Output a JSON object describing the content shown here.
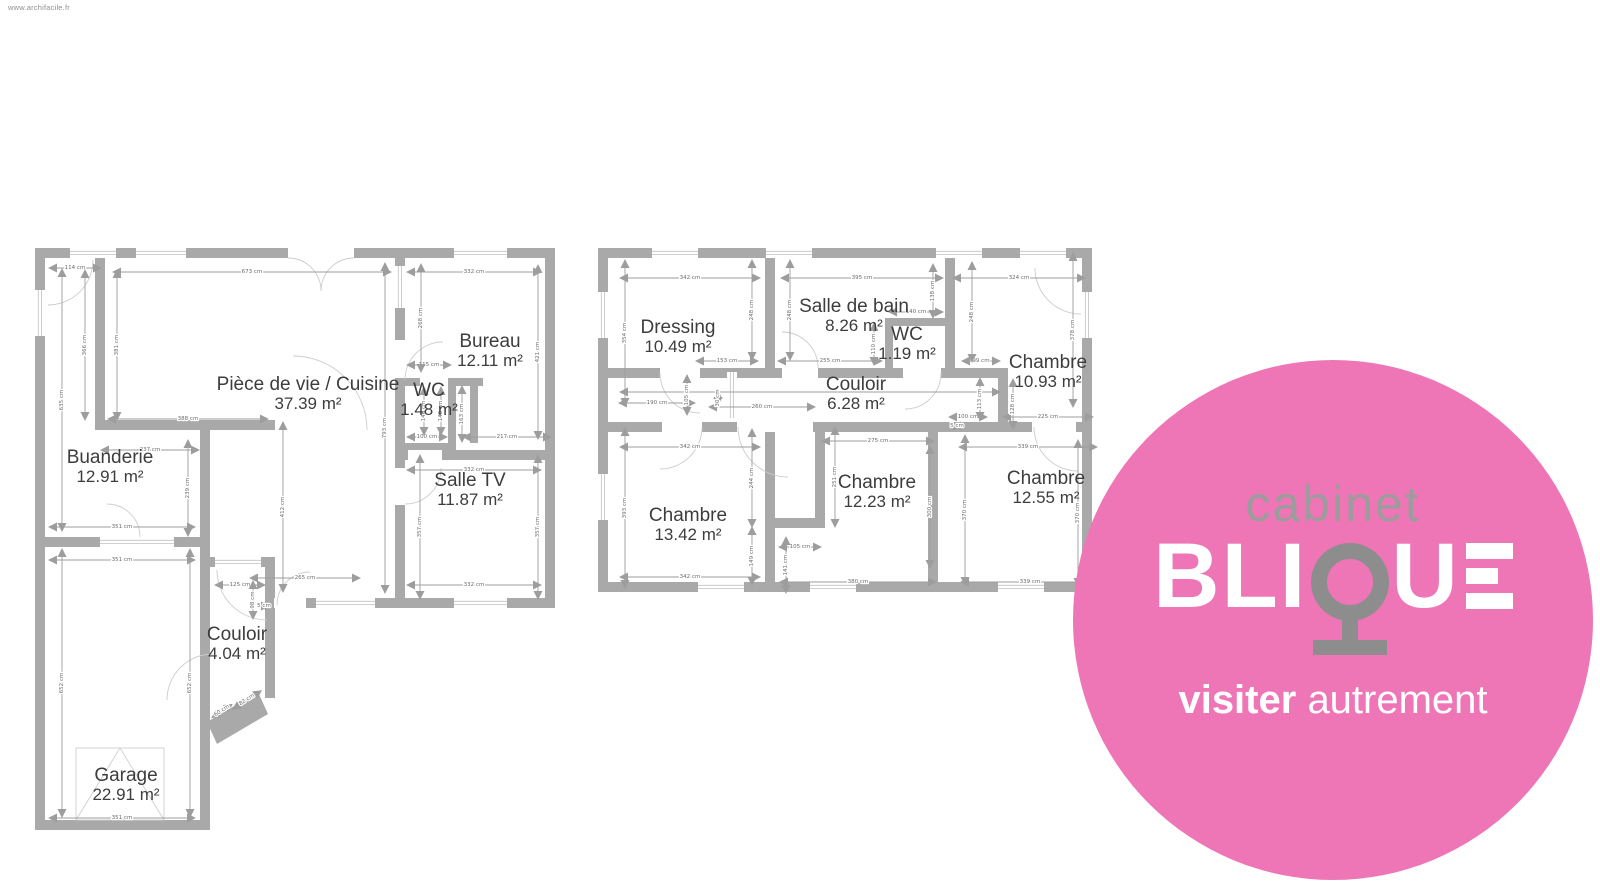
{
  "watermark": "www.archifacile.fr",
  "colors": {
    "wall": "#a9a9a9",
    "dim_line": "#9d9d9d",
    "window_line": "#c0c0c0",
    "door_arc": "#cdcdcd",
    "room_text": "#3d3d3d",
    "logo_pink": "#ee76b6",
    "logo_gray": "#9c9c9c",
    "logo_q_gray": "#8d8d8d",
    "logo_white": "#ffffff"
  },
  "logo": {
    "top_word": "cabinet",
    "brand_bli": "BLI",
    "brand_q": "Q",
    "brand_u": "U",
    "brand_e": "E",
    "tagline_bold": "visiter",
    "tagline_light": "autrement"
  },
  "plans": [
    {
      "id": "ground-floor",
      "rooms": [
        {
          "name": "Pièce de vie / Cuisine",
          "area": "37.39 m²",
          "x": 308,
          "y": 390
        },
        {
          "name": "Bureau",
          "area": "12.11 m²",
          "x": 490,
          "y": 347
        },
        {
          "name": "WC",
          "area": "1.48 m²",
          "x": 429,
          "y": 396
        },
        {
          "name": "Salle TV",
          "area": "11.87 m²",
          "x": 470,
          "y": 486
        },
        {
          "name": "Buanderie",
          "area": "12.91 m²",
          "x": 110,
          "y": 463
        },
        {
          "name": "Couloir",
          "area": "4.04 m²",
          "x": 237,
          "y": 640
        },
        {
          "name": "Garage",
          "area": "22.91 m²",
          "x": 126,
          "y": 781
        }
      ],
      "dims": [
        {
          "t": "114 cm",
          "x": 75,
          "y": 268,
          "o": "h",
          "l": 52
        },
        {
          "t": "673 cm",
          "x": 252,
          "y": 272,
          "o": "h",
          "l": 278
        },
        {
          "t": "332 cm",
          "x": 474,
          "y": 272,
          "o": "h",
          "l": 134
        },
        {
          "t": "115 cm",
          "x": 429,
          "y": 365,
          "o": "h",
          "l": 44
        },
        {
          "t": "388 cm",
          "x": 188,
          "y": 419,
          "o": "h",
          "l": 160
        },
        {
          "t": "237 cm",
          "x": 150,
          "y": 450,
          "o": "h",
          "l": 98
        },
        {
          "t": "351 cm",
          "x": 122,
          "y": 527,
          "o": "h",
          "l": 146
        },
        {
          "t": "351 cm",
          "x": 122,
          "y": 560,
          "o": "h",
          "l": 146
        },
        {
          "t": "100 cm",
          "x": 427,
          "y": 437,
          "o": "h",
          "l": 40
        },
        {
          "t": "217 cm",
          "x": 507,
          "y": 437,
          "o": "h",
          "l": 88
        },
        {
          "t": "332 cm",
          "x": 474,
          "y": 470,
          "o": "h",
          "l": 134
        },
        {
          "t": "265 cm",
          "x": 305,
          "y": 578,
          "o": "h",
          "l": 110
        },
        {
          "t": "332 cm",
          "x": 474,
          "y": 585,
          "o": "h",
          "l": 134
        },
        {
          "t": "125 cm",
          "x": 240,
          "y": 585,
          "o": "h",
          "l": 50
        },
        {
          "t": "5 cm",
          "x": 264,
          "y": 606,
          "o": "h",
          "l": 10
        },
        {
          "t": "351 cm",
          "x": 122,
          "y": 818,
          "o": "h",
          "l": 146
        },
        {
          "t": "366 cm",
          "x": 85,
          "y": 345,
          "o": "v",
          "l": 150
        },
        {
          "t": "381 cm",
          "x": 117,
          "y": 345,
          "o": "v",
          "l": 150
        },
        {
          "t": "635 cm",
          "x": 62,
          "y": 400,
          "o": "v",
          "l": 262
        },
        {
          "t": "268 cm",
          "x": 421,
          "y": 318,
          "o": "v",
          "l": 108
        },
        {
          "t": "421 cm",
          "x": 538,
          "y": 352,
          "o": "v",
          "l": 174
        },
        {
          "t": "793 cm",
          "x": 385,
          "y": 428,
          "o": "v",
          "l": 330
        },
        {
          "t": "146 cm",
          "x": 424,
          "y": 411,
          "o": "v",
          "l": 48
        },
        {
          "t": "148 cm",
          "x": 441,
          "y": 411,
          "o": "v",
          "l": 48
        },
        {
          "t": "163 cm",
          "x": 462,
          "y": 414,
          "o": "v",
          "l": 56
        },
        {
          "t": "239 cm",
          "x": 188,
          "y": 488,
          "o": "v",
          "l": 96
        },
        {
          "t": "357 cm",
          "x": 420,
          "y": 527,
          "o": "v",
          "l": 144
        },
        {
          "t": "357 cm",
          "x": 538,
          "y": 527,
          "o": "v",
          "l": 144
        },
        {
          "t": "412 cm",
          "x": 283,
          "y": 507,
          "o": "v",
          "l": 170
        },
        {
          "t": "98 cm",
          "x": 253,
          "y": 600,
          "o": "v",
          "l": 38
        },
        {
          "t": "652 cm",
          "x": 62,
          "y": 683,
          "o": "v",
          "l": 268
        },
        {
          "t": "652 cm",
          "x": 190,
          "y": 683,
          "o": "v",
          "l": 268
        },
        {
          "t": "60 cm",
          "x": 222,
          "y": 711,
          "o": "d",
          "a": -33,
          "l": 24
        },
        {
          "t": "82 cm",
          "x": 247,
          "y": 700,
          "o": "d",
          "a": -33,
          "l": 34
        }
      ]
    },
    {
      "id": "first-floor",
      "rooms": [
        {
          "name": "Dressing",
          "area": "10.49 m²",
          "x": 678,
          "y": 333
        },
        {
          "name": "Salle de bain",
          "area": "8.26 m²",
          "x": 854,
          "y": 312
        },
        {
          "name": "WC",
          "area": "1.19 m²",
          "x": 907,
          "y": 340
        },
        {
          "name": "Chambre",
          "area": "10.93 m²",
          "x": 1048,
          "y": 368
        },
        {
          "name": "Couloir",
          "area": "6.28 m²",
          "x": 856,
          "y": 390
        },
        {
          "name": "Chambre",
          "area": "13.42 m²",
          "x": 688,
          "y": 521
        },
        {
          "name": "Chambre",
          "area": "12.23 m²",
          "x": 877,
          "y": 488
        },
        {
          "name": "Chambre",
          "area": "12.55 m²",
          "x": 1046,
          "y": 484
        }
      ],
      "dims": [
        {
          "t": "342 cm",
          "x": 690,
          "y": 278,
          "o": "h",
          "l": 140
        },
        {
          "t": "395 cm",
          "x": 862,
          "y": 278,
          "o": "h",
          "l": 162
        },
        {
          "t": "324 cm",
          "x": 1019,
          "y": 278,
          "o": "h",
          "l": 132
        },
        {
          "t": "140 cm",
          "x": 916,
          "y": 312,
          "o": "h",
          "l": 54
        },
        {
          "t": "153 cm",
          "x": 727,
          "y": 361,
          "o": "h",
          "l": 62
        },
        {
          "t": "255 cm",
          "x": 830,
          "y": 361,
          "o": "h",
          "l": 104
        },
        {
          "t": "99 cm",
          "x": 981,
          "y": 361,
          "o": "h",
          "l": 38
        },
        {
          "t": "190 cm",
          "x": 657,
          "y": 403,
          "o": "h",
          "l": 76
        },
        {
          "t": "260 cm",
          "x": 762,
          "y": 407,
          "o": "h",
          "l": 106
        },
        {
          "t": "",
          "x": 810,
          "y": 392,
          "o": "h",
          "l": 380
        },
        {
          "t": "100 cm",
          "x": 968,
          "y": 417,
          "o": "h",
          "l": 38
        },
        {
          "t": "5 cm",
          "x": 957,
          "y": 426,
          "o": "h",
          "l": 8
        },
        {
          "t": "225 cm",
          "x": 1048,
          "y": 417,
          "o": "h",
          "l": 90
        },
        {
          "t": "342 cm",
          "x": 690,
          "y": 447,
          "o": "h",
          "l": 140
        },
        {
          "t": "275 cm",
          "x": 878,
          "y": 441,
          "o": "h",
          "l": 112
        },
        {
          "t": "339 cm",
          "x": 1028,
          "y": 447,
          "o": "h",
          "l": 138
        },
        {
          "t": "105 cm",
          "x": 800,
          "y": 547,
          "o": "h",
          "l": 42
        },
        {
          "t": "342 cm",
          "x": 690,
          "y": 577,
          "o": "h",
          "l": 140
        },
        {
          "t": "380 cm",
          "x": 858,
          "y": 582,
          "o": "h",
          "l": 156
        },
        {
          "t": "339 cm",
          "x": 1030,
          "y": 582,
          "o": "h",
          "l": 138
        },
        {
          "t": "354 cm",
          "x": 625,
          "y": 333,
          "o": "v",
          "l": 146
        },
        {
          "t": "248 cm",
          "x": 752,
          "y": 310,
          "o": "v",
          "l": 100
        },
        {
          "t": "248 cm",
          "x": 790,
          "y": 310,
          "o": "v",
          "l": 100
        },
        {
          "t": "138 cm",
          "x": 933,
          "y": 291,
          "o": "v",
          "l": 54
        },
        {
          "t": "248 cm",
          "x": 972,
          "y": 312,
          "o": "v",
          "l": 100
        },
        {
          "t": "378 cm",
          "x": 1073,
          "y": 330,
          "o": "v",
          "l": 154
        },
        {
          "t": "110 cm",
          "x": 874,
          "y": 344,
          "o": "v",
          "l": 42
        },
        {
          "t": "105 cm",
          "x": 687,
          "y": 395,
          "o": "v",
          "l": 40
        },
        {
          "t": "30 cm",
          "x": 718,
          "y": 398,
          "o": "v",
          "l": 14
        },
        {
          "t": "113 cm",
          "x": 980,
          "y": 399,
          "o": "v",
          "l": 42
        },
        {
          "t": "128 cm",
          "x": 1013,
          "y": 404,
          "o": "v",
          "l": 50
        },
        {
          "t": "393 cm",
          "x": 625,
          "y": 508,
          "o": "v",
          "l": 160
        },
        {
          "t": "244 cm",
          "x": 752,
          "y": 478,
          "o": "v",
          "l": 98
        },
        {
          "t": "149 cm",
          "x": 752,
          "y": 556,
          "o": "v",
          "l": 58
        },
        {
          "t": "251 cm",
          "x": 835,
          "y": 477,
          "o": "v",
          "l": 100
        },
        {
          "t": "300 cm",
          "x": 930,
          "y": 507,
          "o": "v",
          "l": 122
        },
        {
          "t": "141 cm",
          "x": 786,
          "y": 565,
          "o": "v",
          "l": 56
        },
        {
          "t": "370 cm",
          "x": 965,
          "y": 510,
          "o": "v",
          "l": 150
        },
        {
          "t": "370 cm",
          "x": 1078,
          "y": 513,
          "o": "v",
          "l": 146
        }
      ]
    }
  ]
}
